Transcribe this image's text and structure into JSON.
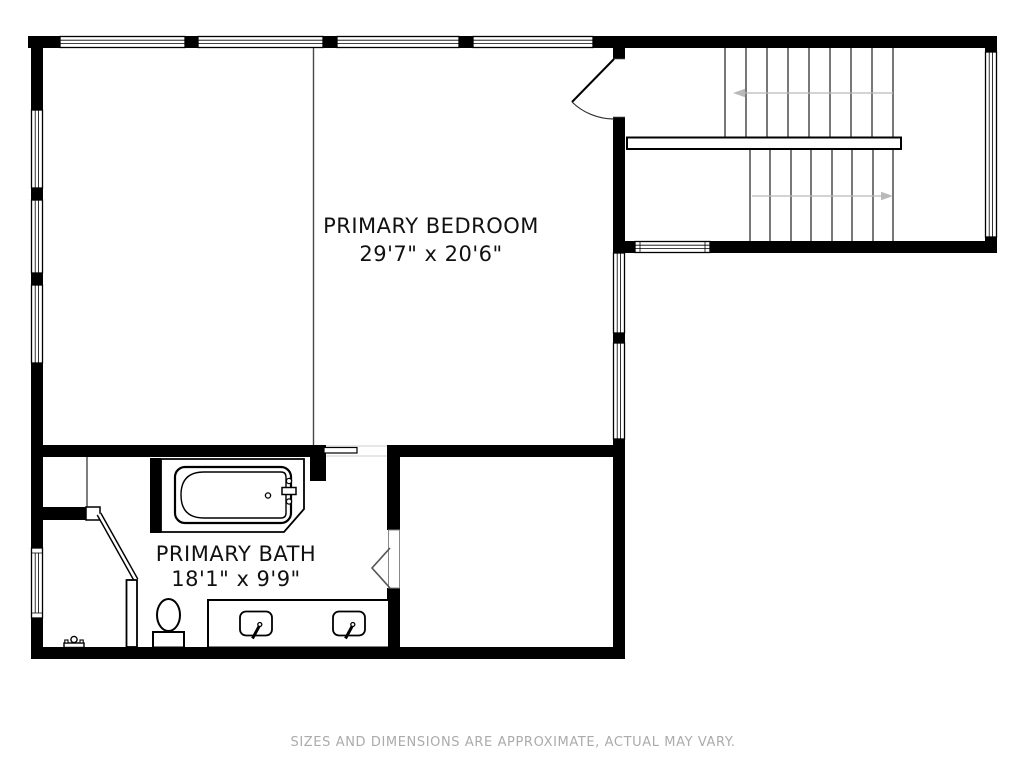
{
  "floor_plan": {
    "rooms": [
      {
        "id": "primary-bedroom",
        "label": "PRIMARY BEDROOM",
        "dimensions": "29'7\" x 20'6\""
      },
      {
        "id": "primary-bath",
        "label": "PRIMARY BATH",
        "dimensions": "18'1\" x 9'9\""
      }
    ],
    "disclaimer": "SIZES AND DIMENSIONS ARE APPROXIMATE, ACTUAL MAY VARY.",
    "colors": {
      "background": "#ffffff",
      "wall": "#000000",
      "stair_tread": "#3f3f3f",
      "direction_arrow": "#b9b9b9",
      "room_label": "#111111",
      "disclaimer": "#ababab"
    }
  }
}
